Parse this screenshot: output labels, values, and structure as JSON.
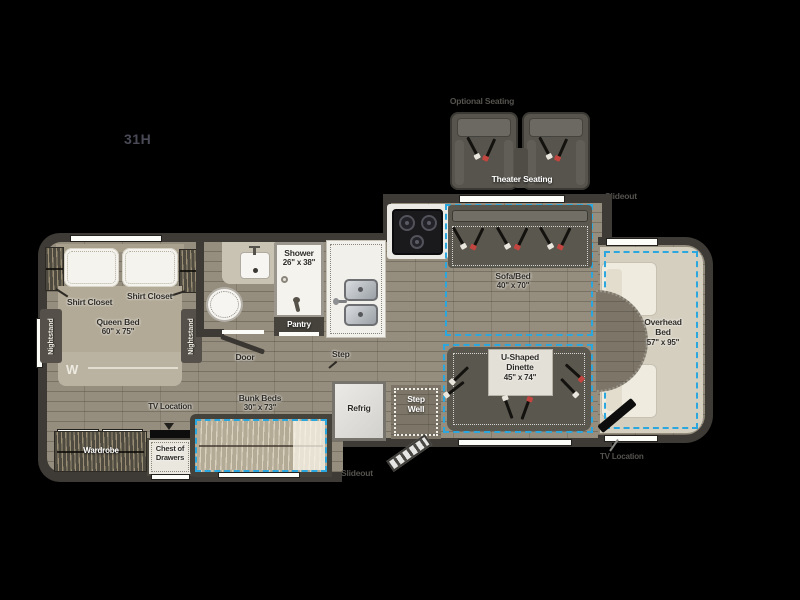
{
  "model": "31H",
  "colors": {
    "slideout_accent": "#2aa7df"
  },
  "exterior": {
    "optional_seating": "Optional Seating",
    "theater_seating": "Theater Seating",
    "slideout_front": "Slideout",
    "slideout_rear": "Slideout",
    "tv_location_cab": "TV Location"
  },
  "bedroom": {
    "shirt_closet_left": "Shirt Closet",
    "shirt_closet_right": "Shirt Closet",
    "queen_bed_name": "Queen Bed",
    "queen_bed_size": "60\" x 75\"",
    "nightstand_left": "Nightstand",
    "nightstand_right": "Nightstand",
    "logo": "W",
    "wardrobe": "Wardrobe"
  },
  "bath": {
    "shower_name": "Shower",
    "shower_size": "26\" x 38\"",
    "pantry": "Pantry",
    "door": "Door",
    "step": "Step"
  },
  "galley": {
    "refrig": "Refrig",
    "step_well_line1": "Step",
    "step_well_line2": "Well"
  },
  "living": {
    "sofa_name": "Sofa/Bed",
    "sofa_size": "40\" x 70\"",
    "dinette_line1": "U-Shaped",
    "dinette_line2": "Dinette",
    "dinette_size": "45\" x 74\""
  },
  "front_cab": {
    "overhead_line1": "Overhead",
    "overhead_line2": "Bed",
    "overhead_size": "57\" x 95\""
  },
  "bunk_area": {
    "bunk_name": "Bunk Beds",
    "bunk_size": "30\" x 73\"",
    "tv_location": "TV Location",
    "chest_line1": "Chest of",
    "chest_line2": "Drawers"
  }
}
